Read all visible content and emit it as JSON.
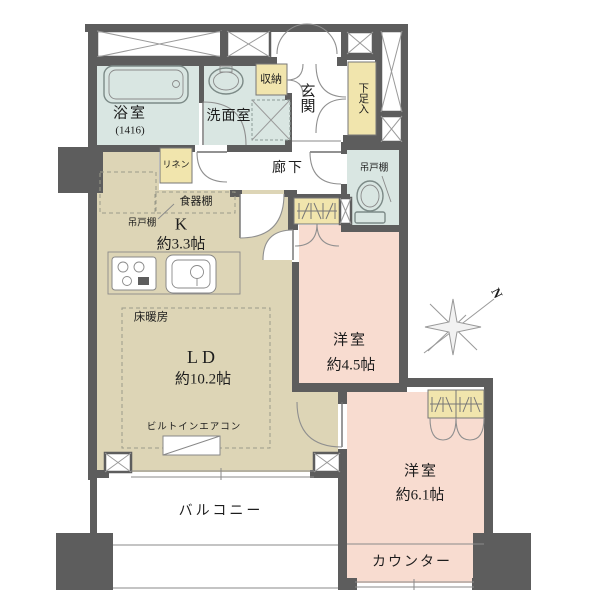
{
  "floorplan": {
    "rooms": {
      "bath": {
        "label": "浴室",
        "size": "(1416)"
      },
      "washroom": {
        "label": "洗面室"
      },
      "storage": {
        "label": "収納"
      },
      "entrance": {
        "label": "玄関"
      },
      "shoe_cabinet": {
        "label": "下足入"
      },
      "linen": {
        "label": "リネン"
      },
      "hallway": {
        "label": "廊下"
      },
      "toilet_cabinet": {
        "label": "吊戸棚"
      },
      "kitchen_cabinet": {
        "label": "吊戸棚"
      },
      "cupboard": {
        "label": "食器棚"
      },
      "kitchen": {
        "label": "K",
        "size": "約3.3帖"
      },
      "living_dining": {
        "label": "LD",
        "size": "約10.2帖"
      },
      "floor_heating": {
        "label": "床暖房"
      },
      "aircon": {
        "label": "ビルトインエアコン"
      },
      "bedroom_45": {
        "label": "洋室",
        "size": "約4.5帖"
      },
      "bedroom_61": {
        "label": "洋室",
        "size": "約6.1帖"
      },
      "counter": {
        "label": "カウンター"
      },
      "balcony": {
        "label": "バルコニー"
      }
    },
    "compass": {
      "label": "N"
    },
    "colors": {
      "wall": "#5d5d5d",
      "wet_area": "#d9e6e2",
      "wood_area": "#ddd5b6",
      "bedroom": "#f8dcd0",
      "closet": "#f1e5ad"
    }
  }
}
